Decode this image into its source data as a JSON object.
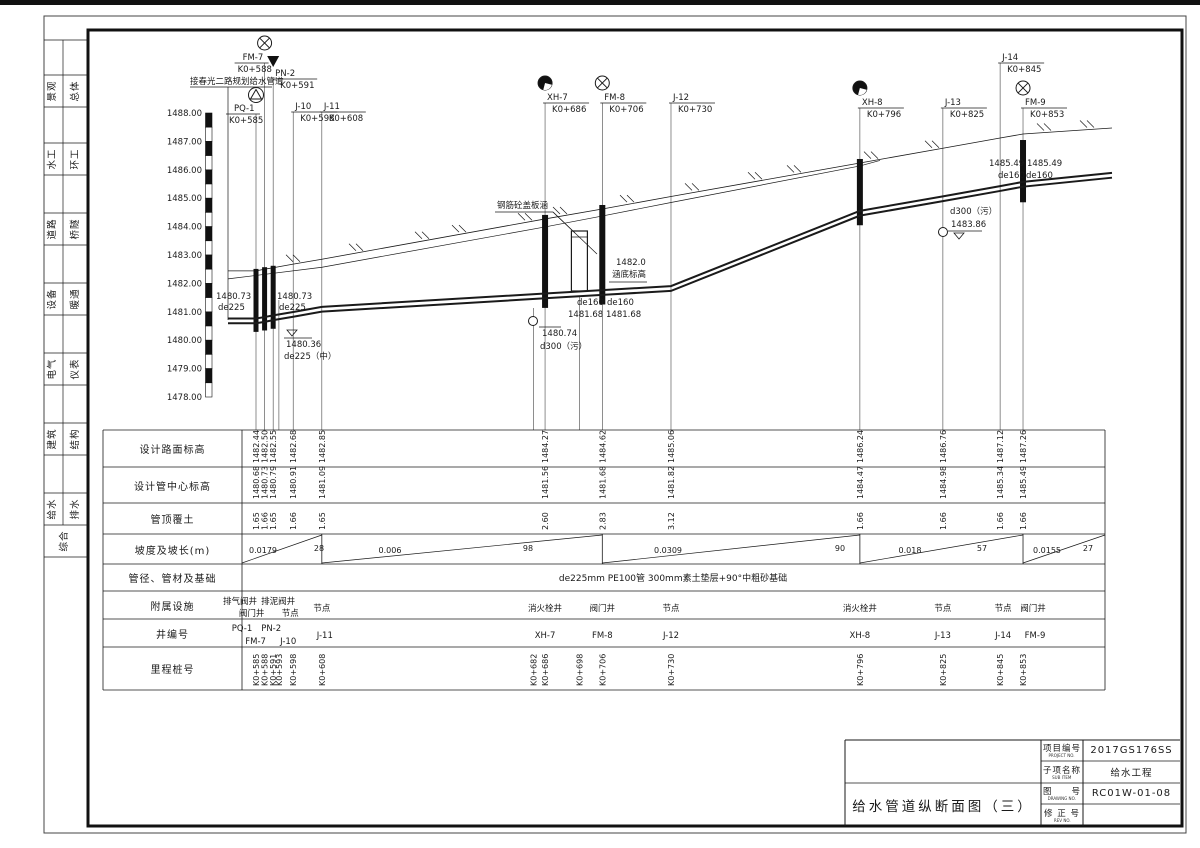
{
  "sidebar": {
    "disciplines": [
      {
        "a": "景观",
        "b": "总体"
      },
      {
        "a": "水工",
        "b": "环工"
      },
      {
        "a": "道路",
        "b": "桥隧"
      },
      {
        "a": "设备",
        "b": "暖通"
      },
      {
        "a": "电气",
        "b": "仪表"
      },
      {
        "a": "建筑",
        "b": "结构"
      },
      {
        "a": "给水",
        "b": "排水"
      }
    ],
    "bottom": "综合"
  },
  "axis": {
    "top": 1488,
    "bottom": 1478,
    "labels": [
      "1488.00",
      "1487.00",
      "1486.00",
      "1485.00",
      "1484.00",
      "1483.00",
      "1482.00",
      "1481.00",
      "1480.00",
      "1479.00",
      "1478.00"
    ]
  },
  "profile": {
    "connect_note": "接春光二路规划给水管道",
    "wells": [
      {
        "id": "PQ-1",
        "station": 585,
        "station_label": "K0+585",
        "sym": "blowoff",
        "uy": 114,
        "side": "left"
      },
      {
        "id": "FM-7",
        "station": 588,
        "station_label": "K0+588",
        "sym": "valve",
        "uy": 63,
        "side": "left"
      },
      {
        "id": "PN-2",
        "station": 591,
        "station_label": "K0+591",
        "sym": "drain",
        "uy": 79,
        "side": "right"
      },
      {
        "id": "J-10",
        "station": 598,
        "station_label": "K0+598",
        "sym": "",
        "uy": 112,
        "side": "right"
      },
      {
        "id": "J-11",
        "station": 608,
        "station_label": "K0+608",
        "sym": "",
        "uy": 112,
        "side": "right"
      },
      {
        "id": "XH-7",
        "station": 686,
        "station_label": "K0+686",
        "sym": "hydrant",
        "uy": 103,
        "side": "right"
      },
      {
        "id": "FM-8",
        "station": 706,
        "station_label": "K0+706",
        "sym": "valve",
        "uy": 103,
        "side": "right"
      },
      {
        "id": "J-12",
        "station": 730,
        "station_label": "K0+730",
        "sym": "",
        "uy": 103,
        "side": "right"
      },
      {
        "id": "XH-8",
        "station": 796,
        "station_label": "K0+796",
        "sym": "hydrant",
        "uy": 108,
        "side": "right"
      },
      {
        "id": "J-13",
        "station": 825,
        "station_label": "K0+825",
        "sym": "",
        "uy": 108,
        "side": "right"
      },
      {
        "id": "J-14",
        "station": 845,
        "station_label": "K0+845",
        "sym": "",
        "uy": 63,
        "side": "right"
      },
      {
        "id": "FM-9",
        "station": 853,
        "station_label": "K0+853",
        "sym": "valve",
        "uy": 108,
        "side": "right"
      }
    ],
    "extra_station_lines": [
      {
        "station": 593,
        "y1": 300
      },
      {
        "station": 682,
        "y1": 308
      },
      {
        "station": 698,
        "y1": 296
      }
    ],
    "riser_stations": [
      585,
      588,
      591,
      686,
      706,
      796,
      853
    ],
    "culvert_station": 698,
    "annotations": [
      {
        "t": "接春光二路规划给水管道",
        "x": 190,
        "y": 84
      },
      {
        "t": "1480.73",
        "x": 216,
        "y": 299
      },
      {
        "t": "de225",
        "x": 218,
        "y": 310
      },
      {
        "t": "1480.73",
        "x": 277,
        "y": 299
      },
      {
        "t": "de225",
        "x": 279,
        "y": 310
      },
      {
        "t": "1480.36",
        "x": 286,
        "y": 347
      },
      {
        "t": "de225（中）",
        "x": 284,
        "y": 359
      },
      {
        "t": "de160",
        "x": 577,
        "y": 305
      },
      {
        "t": "1481.68",
        "x": 568,
        "y": 317
      },
      {
        "t": "de160",
        "x": 607,
        "y": 305
      },
      {
        "t": "1481.68",
        "x": 606,
        "y": 317
      },
      {
        "t": "1480.74",
        "x": 542,
        "y": 336
      },
      {
        "t": "d300（污）",
        "x": 540,
        "y": 349
      },
      {
        "t": "1482.0",
        "x": 616,
        "y": 265
      },
      {
        "t": "涵底标高",
        "x": 612,
        "y": 277
      },
      {
        "t": "钢筋砼盖板涵",
        "x": 497,
        "y": 208
      },
      {
        "t": "1485.49",
        "x": 989,
        "y": 166
      },
      {
        "t": "1485.49",
        "x": 1027,
        "y": 166
      },
      {
        "t": "de160",
        "x": 998,
        "y": 178
      },
      {
        "t": "de160",
        "x": 1026,
        "y": 178
      },
      {
        "t": "d300（污）",
        "x": 950,
        "y": 214
      },
      {
        "t": "1483.86",
        "x": 951,
        "y": 227
      }
    ],
    "marks": [
      [
        190,
        87,
        272,
        87
      ],
      [
        228,
        87,
        228,
        320
      ],
      [
        284,
        338,
        312,
        338
      ],
      [
        539,
        327,
        561,
        327
      ],
      [
        609,
        282,
        647,
        282
      ],
      [
        495,
        212,
        553,
        212
      ],
      [
        553,
        212,
        575,
        233
      ],
      [
        553,
        212,
        597,
        254
      ],
      [
        948,
        231,
        982,
        231
      ]
    ],
    "tri_marks": [
      [
        959,
        233
      ],
      [
        292,
        330
      ]
    ],
    "crossings": [
      [
        533,
        321
      ],
      [
        943,
        232
      ]
    ],
    "hatch_x": [
      295,
      358,
      424,
      461,
      527,
      562,
      629,
      694,
      757,
      796,
      873,
      934,
      1046,
      1089
    ]
  },
  "table": {
    "row_labels": [
      "设计路面标高",
      "设计管中心标高",
      "管顶覆土",
      "坡度及坡长(m)",
      "管径、管材及基础",
      "附属设施",
      "井编号",
      "里程桩号"
    ],
    "columns": [
      {
        "s": 585,
        "road": "1482.44",
        "pipe": "1480.68",
        "cover": "1.65"
      },
      {
        "s": 588,
        "road": "1482.50",
        "pipe": "1480.73",
        "cover": "1.66"
      },
      {
        "s": 591,
        "road": "1482.55",
        "pipe": "1480.79",
        "cover": "1.65"
      },
      {
        "s": 598,
        "road": "1482.68",
        "pipe": "1480.91",
        "cover": "1.66"
      },
      {
        "s": 608,
        "road": "1482.85",
        "pipe": "1481.09",
        "cover": "1.65"
      },
      {
        "s": 686,
        "road": "1484.27",
        "pipe": "1481.56",
        "cover": "2.60"
      },
      {
        "s": 706,
        "road": "1484.62",
        "pipe": "1481.68",
        "cover": "2.83"
      },
      {
        "s": 730,
        "road": "1485.06",
        "pipe": "1481.82",
        "cover": "3.12"
      },
      {
        "s": 796,
        "road": "1486.24",
        "pipe": "1484.47",
        "cover": "1.66"
      },
      {
        "s": 825,
        "road": "1486.76",
        "pipe": "1484.98",
        "cover": "1.66"
      },
      {
        "s": 845,
        "road": "1487.12",
        "pipe": "1485.34",
        "cover": "1.66"
      },
      {
        "s": 853,
        "road": "1487.26",
        "pipe": "1485.49",
        "cover": "1.66"
      }
    ],
    "slopes": [
      {
        "slope": "0.0179",
        "len": "28",
        "from": 585,
        "to": 608,
        "sx": 263,
        "lx": 319
      },
      {
        "slope": "0.006",
        "len": "98",
        "from": 608,
        "to": 706,
        "sx": 390,
        "lx": 528
      },
      {
        "slope": "0.0309",
        "len": "90",
        "from": 706,
        "to": 796,
        "sx": 668,
        "lx": 840
      },
      {
        "slope": "0.018",
        "len": "57",
        "from": 796,
        "to": 853,
        "sx": 910,
        "lx": 982
      },
      {
        "slope": "0.0155",
        "len": "27",
        "from": 853,
        "to": null,
        "sx": 1047,
        "lx": 1088
      }
    ],
    "pipe_spec": "de225mm  PE100管  300mm素土垫层+90°中粗砂基础",
    "facilities": [
      {
        "s": 585,
        "t": "排气阀井",
        "ln": 1,
        "dx": -16
      },
      {
        "s": 591,
        "t": "排泥阀井",
        "ln": 1,
        "dx": 5
      },
      {
        "s": 588,
        "t": "阀门井",
        "ln": 2,
        "dx": -13
      },
      {
        "s": 598,
        "t": "节点",
        "ln": 2,
        "dx": -3
      },
      {
        "s": 608,
        "t": "节点",
        "ln": 0,
        "dx": 0
      },
      {
        "s": 686,
        "t": "消火栓井",
        "ln": 0,
        "dx": 0
      },
      {
        "s": 706,
        "t": "阀门井",
        "ln": 0,
        "dx": 0
      },
      {
        "s": 730,
        "t": "节点",
        "ln": 0,
        "dx": 0
      },
      {
        "s": 796,
        "t": "消火栓井",
        "ln": 0,
        "dx": 0
      },
      {
        "s": 825,
        "t": "节点",
        "ln": 0,
        "dx": 0
      },
      {
        "s": 845,
        "t": "节点",
        "ln": 0,
        "dx": 3
      },
      {
        "s": 853,
        "t": "阀门井",
        "ln": 0,
        "dx": 10
      }
    ],
    "well_ids": [
      {
        "s": 585,
        "t": "PQ-1",
        "ln": 1,
        "dx": -14
      },
      {
        "s": 591,
        "t": "PN-2",
        "ln": 1,
        "dx": -2
      },
      {
        "s": 588,
        "t": "FM-7",
        "ln": 2,
        "dx": -9
      },
      {
        "s": 598,
        "t": "J-10",
        "ln": 2,
        "dx": -5
      },
      {
        "s": 608,
        "t": "J-11",
        "ln": 0,
        "dx": 3
      },
      {
        "s": 686,
        "t": "XH-7",
        "ln": 0,
        "dx": 0
      },
      {
        "s": 706,
        "t": "FM-8",
        "ln": 0,
        "dx": 0
      },
      {
        "s": 730,
        "t": "J-12",
        "ln": 0,
        "dx": 0
      },
      {
        "s": 796,
        "t": "XH-8",
        "ln": 0,
        "dx": 0
      },
      {
        "s": 825,
        "t": "J-13",
        "ln": 0,
        "dx": 0
      },
      {
        "s": 845,
        "t": "J-14",
        "ln": 0,
        "dx": 3
      },
      {
        "s": 853,
        "t": "FM-9",
        "ln": 0,
        "dx": 12
      }
    ],
    "stations_row": [
      {
        "s": 585,
        "t": "K0+585"
      },
      {
        "s": 588,
        "t": "K0+588"
      },
      {
        "s": 591,
        "t": "K0+591"
      },
      {
        "s": 593,
        "t": "K0+593"
      },
      {
        "s": 598,
        "t": "K0+598"
      },
      {
        "s": 608,
        "t": "K0+608"
      },
      {
        "s": 682,
        "t": "K0+682"
      },
      {
        "s": 686,
        "t": "K0+686"
      },
      {
        "s": 698,
        "t": "K0+698"
      },
      {
        "s": 706,
        "t": "K0+706"
      },
      {
        "s": 730,
        "t": "K0+730"
      },
      {
        "s": 796,
        "t": "K0+796"
      },
      {
        "s": 825,
        "t": "K0+825"
      },
      {
        "s": 845,
        "t": "K0+845"
      },
      {
        "s": 853,
        "t": "K0+853"
      }
    ]
  },
  "title_block": {
    "drawing_title": "给水管道纵断面图（三）",
    "rows": [
      {
        "cn": "项目编号",
        "en": "PROJECT NO.",
        "value": "2017GS176SS"
      },
      {
        "cn": "子项名称",
        "en": "SUB ITEM",
        "value": "给水工程"
      },
      {
        "cn": "图　　号",
        "en": "DRAWING NO.",
        "value": "RC01W-01-08"
      },
      {
        "cn": "修 正 号",
        "en": "REV NO.",
        "value": ""
      }
    ]
  }
}
